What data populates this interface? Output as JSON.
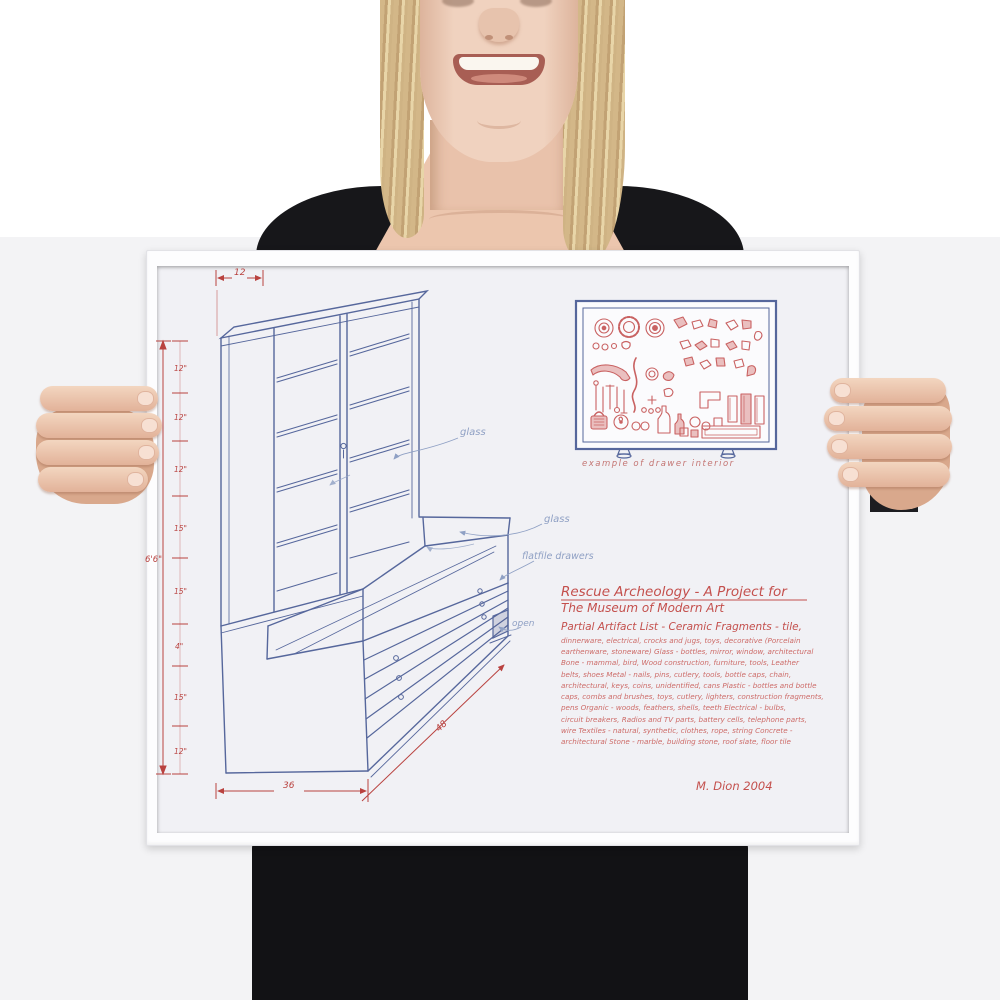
{
  "scene": {
    "description": "Photo of a smiling blonde woman in a black top holding a white-framed art print",
    "wall_color_top": "#ffffff",
    "wall_color_bottom": "#f3f3f5",
    "shirt_color": "#17171a",
    "skin_color": "#ecc6ae",
    "hair_color": "#d3b788",
    "frame_color": "#fdfdfe"
  },
  "poster": {
    "ink_blue": "#56679c",
    "pencil_blue": "#8fa0c4",
    "ink_red": "#b9423f",
    "hand_red": "#c4504d",
    "list_red": "#cd6b68",
    "dims": {
      "top_width": "12",
      "left_total": "6'6\"",
      "left_segments": [
        "12\"",
        "12\"",
        "12\"",
        "15\"",
        "15\"",
        "4\"",
        "15\"",
        "12\""
      ],
      "bottom_width": "36",
      "depth": "48"
    },
    "labels": {
      "glass_upper": "glass",
      "glass_lower": "glass",
      "flatfile": "flatfile drawers",
      "open": "open"
    },
    "panel_caption": "example of drawer interior",
    "title_line1": "Rescue Archeology - A Project for",
    "title_line2": "The Museum of Modern Art",
    "list_intro": "Partial Artifact List - Ceramic Fragments - tile,",
    "list": [
      "dinnerware, electrical, crocks and jugs, toys, decorative (Porcelain",
      "earthenware, stoneware) Glass - bottles, mirror, window, architectural",
      "Bone - mammal, bird, Wood construction, furniture, tools, Leather",
      "belts, shoes  Metal - nails, pins, cutlery, tools, bottle caps, chain,",
      "architectural, keys, coins, unidentified, cans  Plastic - bottles and bottle",
      "caps, combs and brushes, toys, cutlery, lighters, construction fragments,",
      "pens  Organic - woods, feathers, shells, teeth  Electrical - bulbs,",
      "circuit breakers, Radios and TV parts, battery cells, telephone parts,",
      "wire  Textiles - natural, synthetic, clothes, rope, string  Concrete -",
      "architectural  Stone - marble, building stone, roof slate, floor tile"
    ],
    "signature": "M. Dion    2004"
  }
}
